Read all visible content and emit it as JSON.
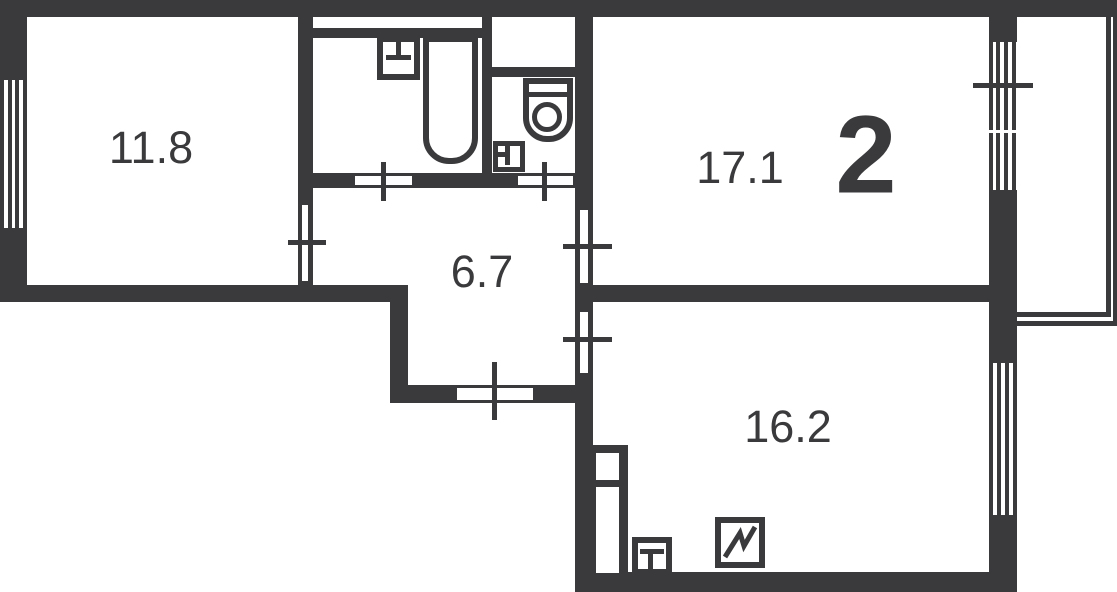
{
  "floorplan": {
    "apartment_type_label": "2",
    "rooms": [
      {
        "id": "room-top-left",
        "area_label": "11.8"
      },
      {
        "id": "room-top-right",
        "area_label": "17.1"
      },
      {
        "id": "hallway",
        "area_label": "6.7"
      },
      {
        "id": "kitchen",
        "area_label": "16.2"
      }
    ],
    "fixtures": [
      "bathtub",
      "washbasin",
      "toilet",
      "wc-washbasin",
      "kitchen-sink",
      "stove"
    ],
    "features": [
      "left-window",
      "balcony-door",
      "balcony-window",
      "kitchen-window",
      "balcony",
      "entrance-door",
      "vent-duct"
    ],
    "colors": {
      "wall": "#3a3a3c",
      "floor": "#ffffff"
    }
  }
}
